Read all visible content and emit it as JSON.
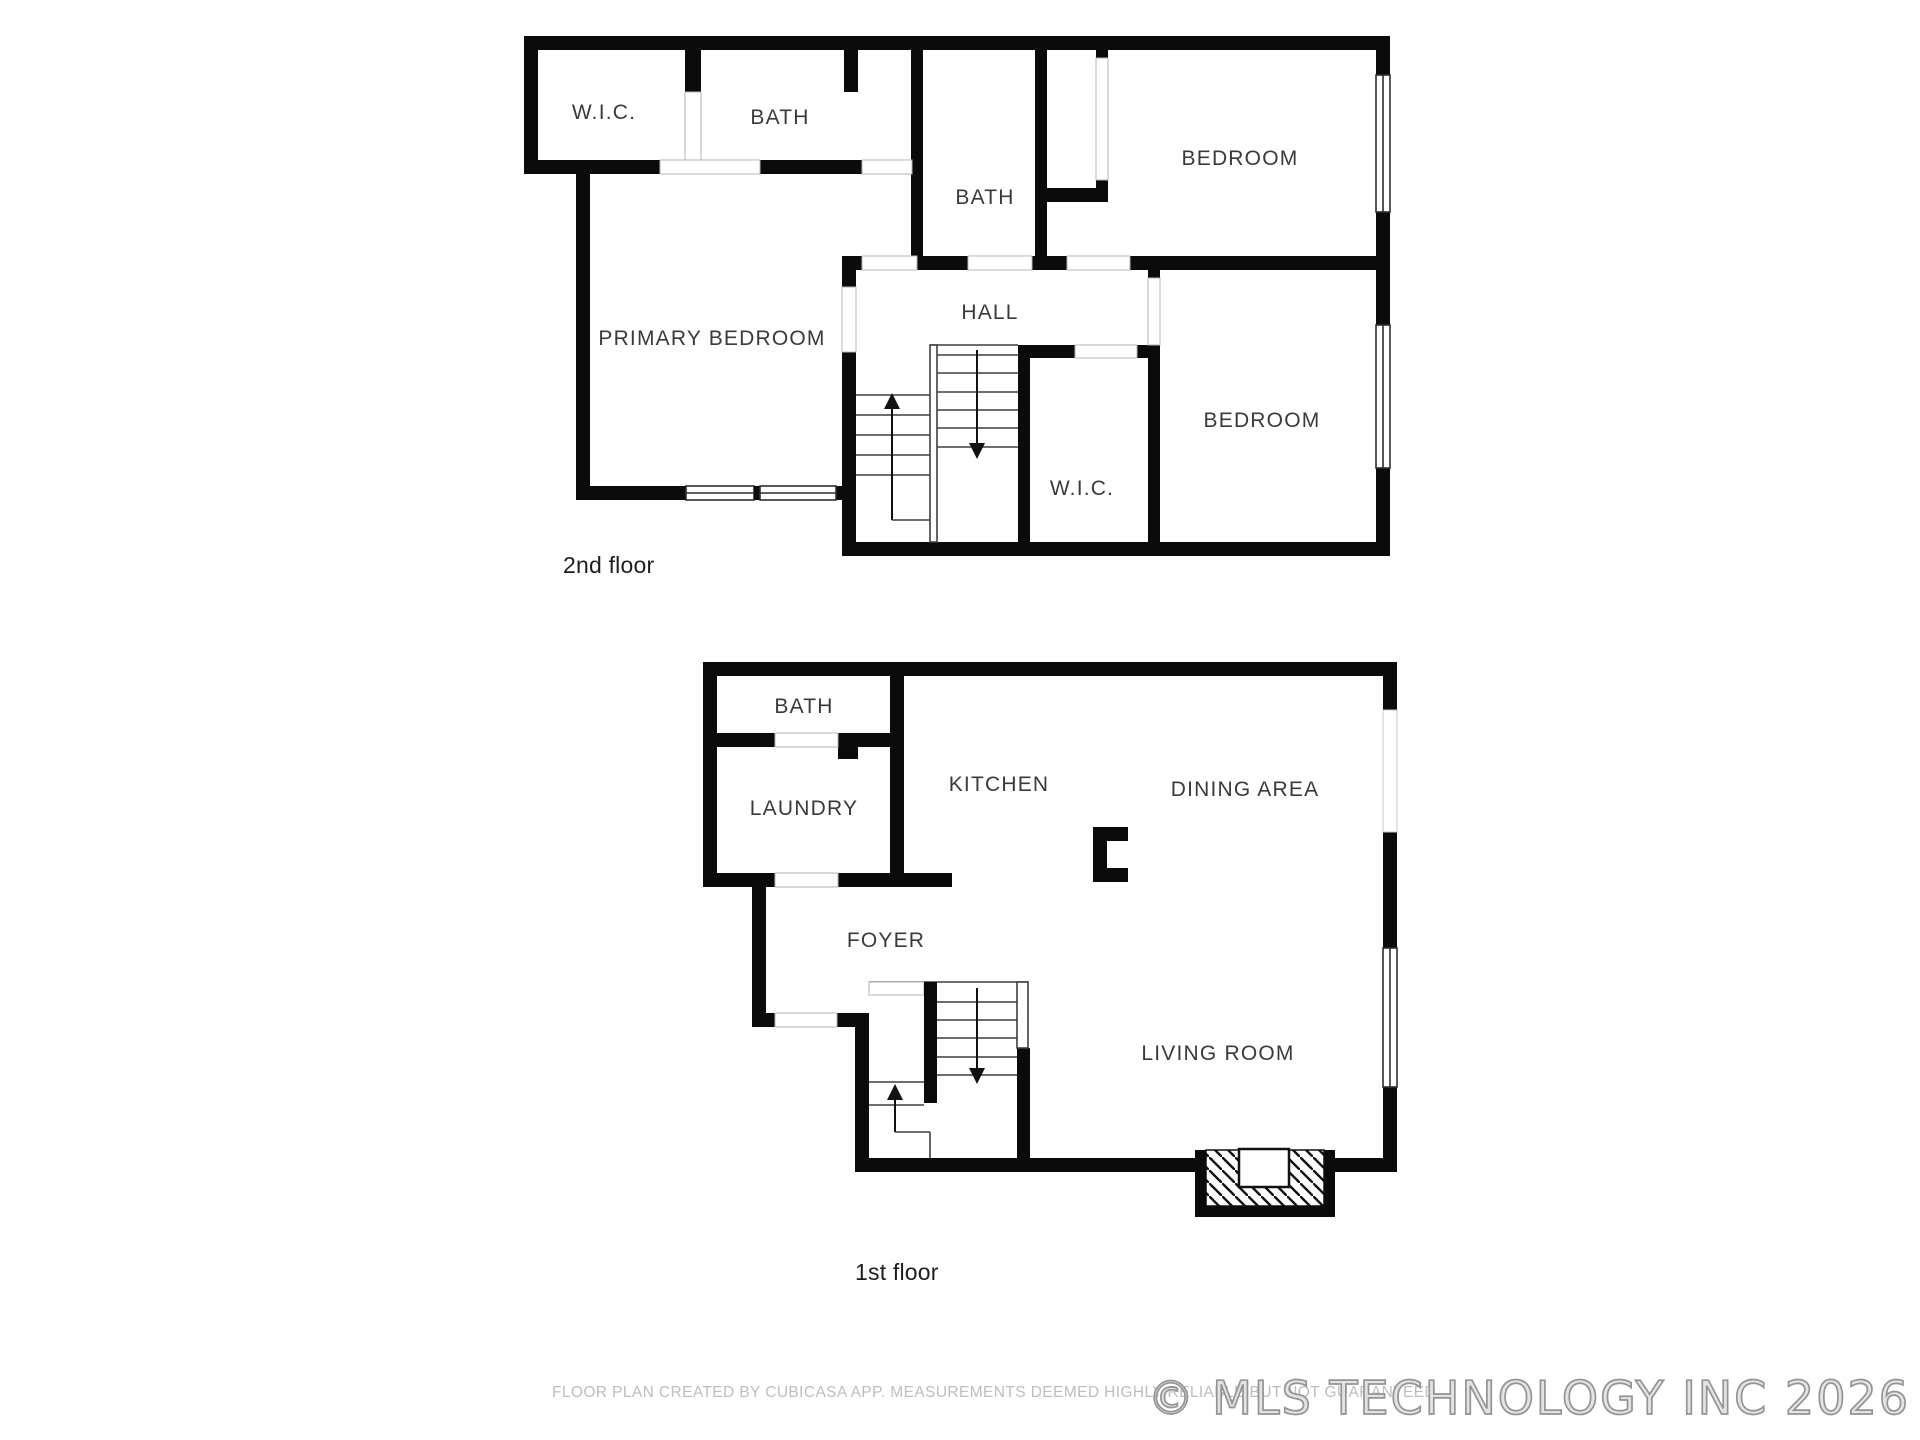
{
  "floors": [
    {
      "label": "2nd floor",
      "rooms": [
        {
          "name": "wic-left",
          "label": "W.I.C."
        },
        {
          "name": "bath-left",
          "label": "BATH"
        },
        {
          "name": "bath-middle",
          "label": "BATH"
        },
        {
          "name": "bedroom-top",
          "label": "BEDROOM"
        },
        {
          "name": "primary-bedroom",
          "label": "PRIMARY BEDROOM"
        },
        {
          "name": "hall",
          "label": "HALL"
        },
        {
          "name": "bedroom-lower",
          "label": "BEDROOM"
        },
        {
          "name": "wic-center",
          "label": "W.I.C."
        }
      ]
    },
    {
      "label": "1st floor",
      "rooms": [
        {
          "name": "bath",
          "label": "BATH"
        },
        {
          "name": "laundry",
          "label": "LAUNDRY"
        },
        {
          "name": "kitchen",
          "label": "KITCHEN"
        },
        {
          "name": "dining-area",
          "label": "DINING AREA"
        },
        {
          "name": "foyer",
          "label": "FOYER"
        },
        {
          "name": "living-room",
          "label": "LIVING ROOM"
        }
      ]
    }
  ],
  "footer": {
    "disclaimer": "FLOOR PLAN CREATED BY CUBICASA APP. MEASUREMENTS DEEMED HIGHLY RELIABLE BUT NOT GUARANTEED",
    "watermark": "© MLS TECHNOLOGY INC 2026"
  },
  "colors": {
    "wall": "#0b0b0b",
    "room_label": "#3a3a3a",
    "disclaimer": "#bdbdbd",
    "watermark_fill": "#e3e3e3",
    "watermark_stroke": "#949494"
  }
}
